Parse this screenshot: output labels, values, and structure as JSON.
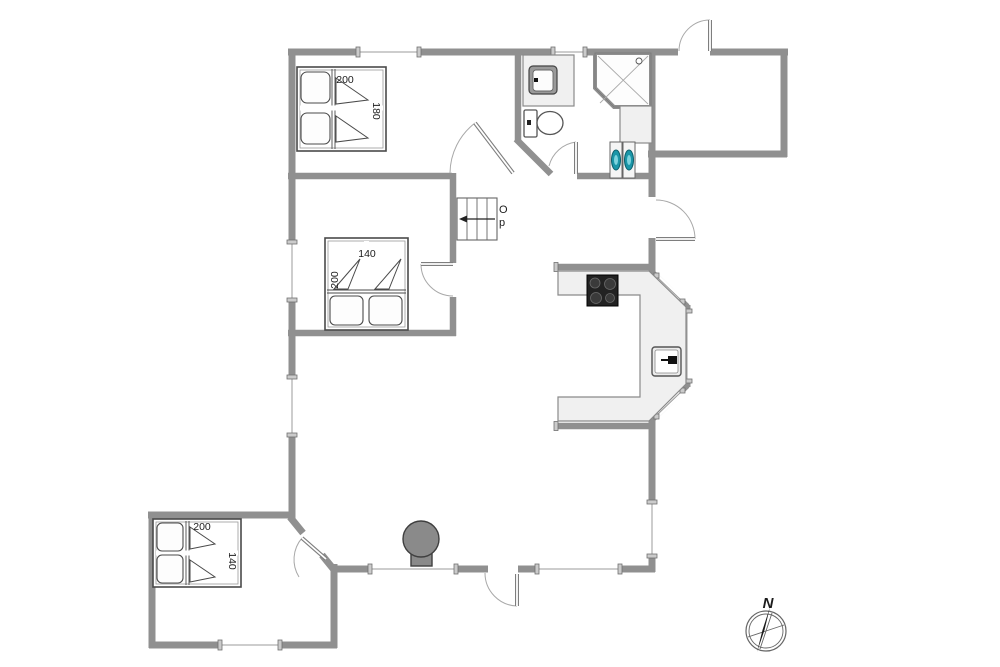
{
  "plan": {
    "type": "house-floor-plan",
    "labels": {
      "bed_top": {
        "width": "200",
        "depth": "180"
      },
      "bed_mid": {
        "width": "140",
        "depth": "200"
      },
      "bed_annex": {
        "width": "200",
        "depth": "140"
      },
      "stairs_line1": "O",
      "stairs_line2": "p",
      "compass_north": "N"
    },
    "colors": {
      "wall": "#909090",
      "counter": "#f0f0f0",
      "cooktop": "#222222",
      "burner": "#3a3a3a",
      "appliance_teal": "#1b96a8",
      "appliance_teal_inner": "#7fd4de",
      "stove_gray": "#8a8a8a",
      "needle_black": "#1a1a1a"
    }
  }
}
